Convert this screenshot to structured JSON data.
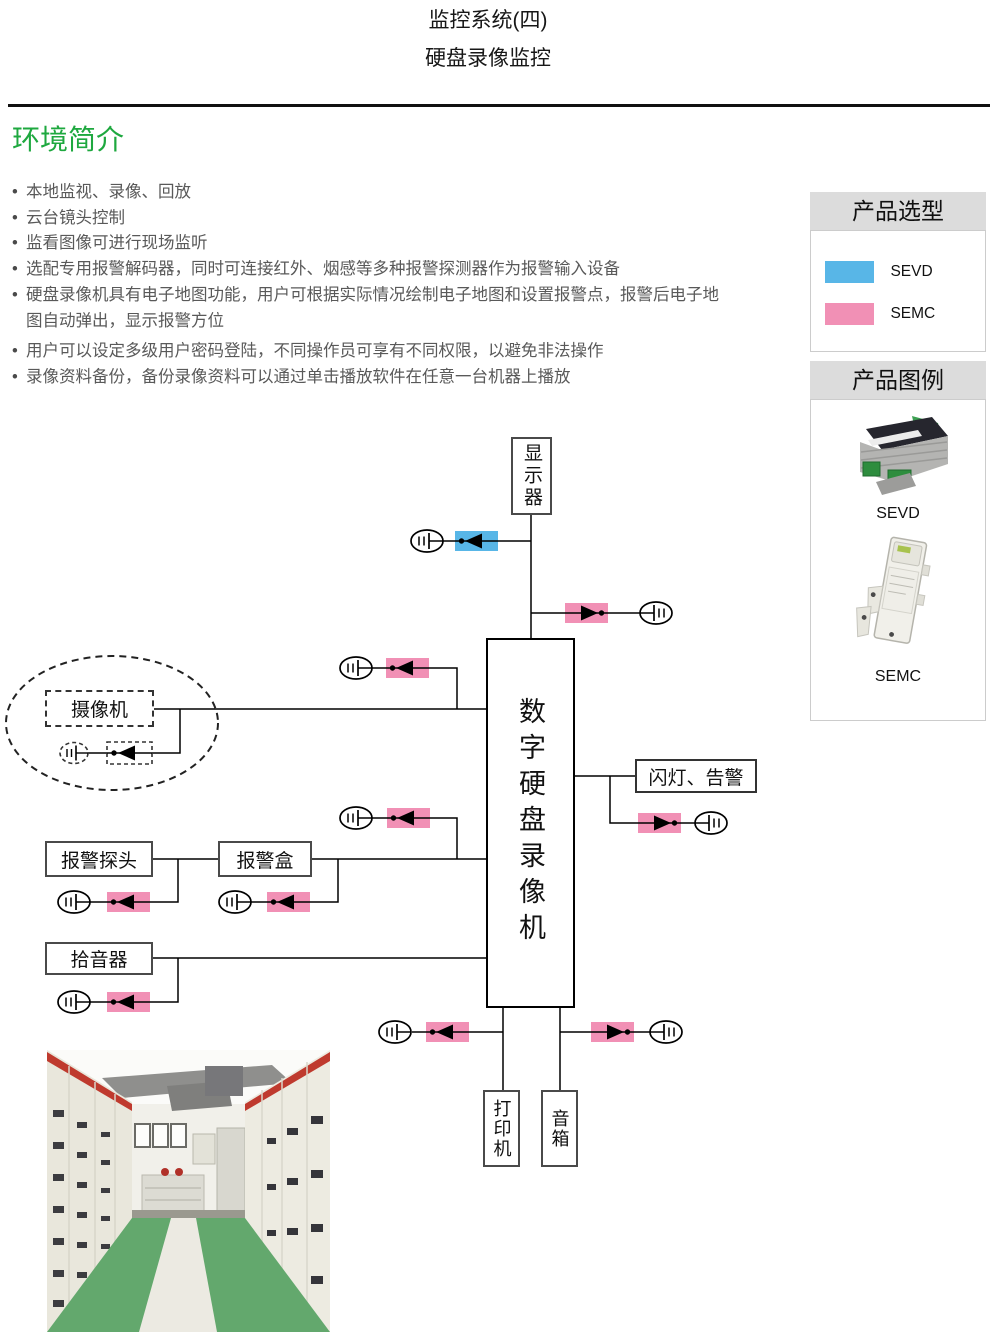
{
  "page": {
    "title_line1": "监控系统(四)",
    "title_line2": "硬盘录像监控",
    "section_heading": "环境简介"
  },
  "bullets": [
    "本地监视、录像、回放",
    "云台镜头控制",
    "监看图像可进行现场监听",
    "选配专用报警解码器，同时可连接红外、烟感等多种报警探测器作为报警输入设备",
    "硬盘录像机具有电子地图功能，用户可根据实际情况绘制电子地图和设置报警点，报警后电子地图自动弹出，显示报警方位",
    "用户可以设定多级用户密码登陆，不同操作员可享有不同权限，以避免非法操作",
    "录像资料备份，备份录像资料可以通过单击播放软件在任意一台机器上播放"
  ],
  "colors": {
    "sevd_blue": "#58b6e7",
    "semc_pink": "#f190b5",
    "heading_green": "#1ea83f",
    "header_gray": "#dcdcdc"
  },
  "sidebar": {
    "selection_title": "产品选型",
    "selection_items": [
      {
        "label": "SEVD",
        "color": "#58b6e7"
      },
      {
        "label": "SEMC",
        "color": "#f190b5"
      }
    ],
    "legend_title": "产品图例",
    "legend_items": [
      {
        "label": "SEVD"
      },
      {
        "label": "SEMC"
      }
    ]
  },
  "diagram": {
    "nodes": {
      "monitor": "显示器",
      "dvr": "数字硬盘录像机",
      "camera": "摄像机",
      "alarm_light": "闪灯、告警",
      "alarm_probe": "报警探头",
      "alarm_box": "报警盒",
      "sound_pickup": "拾音器",
      "printer": "打印机",
      "speaker": "音箱"
    }
  }
}
